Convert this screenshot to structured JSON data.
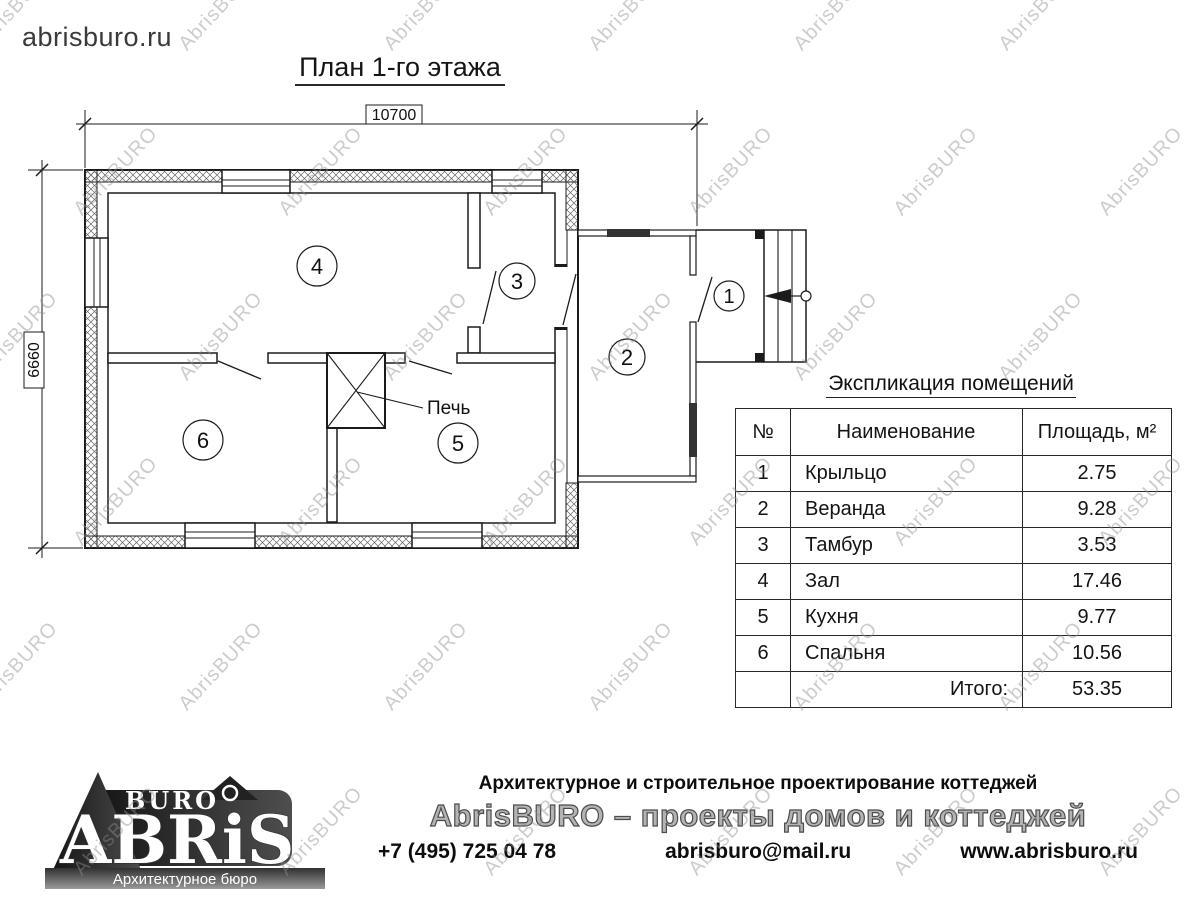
{
  "page": {
    "site": "abrisburo.ru",
    "title": "План 1-го этажа",
    "watermark": "AbrisBURO"
  },
  "plan": {
    "dim_width": "10700",
    "dim_height": "6660",
    "stove_label": "Печь",
    "rooms": [
      {
        "number": "1"
      },
      {
        "number": "2"
      },
      {
        "number": "3"
      },
      {
        "number": "4"
      },
      {
        "number": "5"
      },
      {
        "number": "6"
      }
    ]
  },
  "table": {
    "title": "Экспликация помещений",
    "columns": [
      "№",
      "Наименование",
      "Площадь, м²"
    ],
    "rows": [
      {
        "num": "1",
        "name": "Крыльцо",
        "area": "2.75"
      },
      {
        "num": "2",
        "name": "Веранда",
        "area": "9.28"
      },
      {
        "num": "3",
        "name": "Тамбур",
        "area": "3.53"
      },
      {
        "num": "4",
        "name": "Зал",
        "area": "17.46"
      },
      {
        "num": "5",
        "name": "Кухня",
        "area": "9.77"
      },
      {
        "num": "6",
        "name": "Спальня",
        "area": "10.56"
      }
    ],
    "total_label": "Итого:",
    "total_value": "53.35"
  },
  "footer": {
    "logo": {
      "abris": "ABRiS",
      "buro": "BURO",
      "tagline": "Архитектурное бюро"
    },
    "line1": "Архитектурное и строительное проектирование коттеджей",
    "line2": "AbrisBURO – проекты домов и коттеджей",
    "phone": "+7 (495) 725 04 78",
    "email": "abrisburo@mail.ru",
    "site": "www.abrisburo.ru"
  }
}
